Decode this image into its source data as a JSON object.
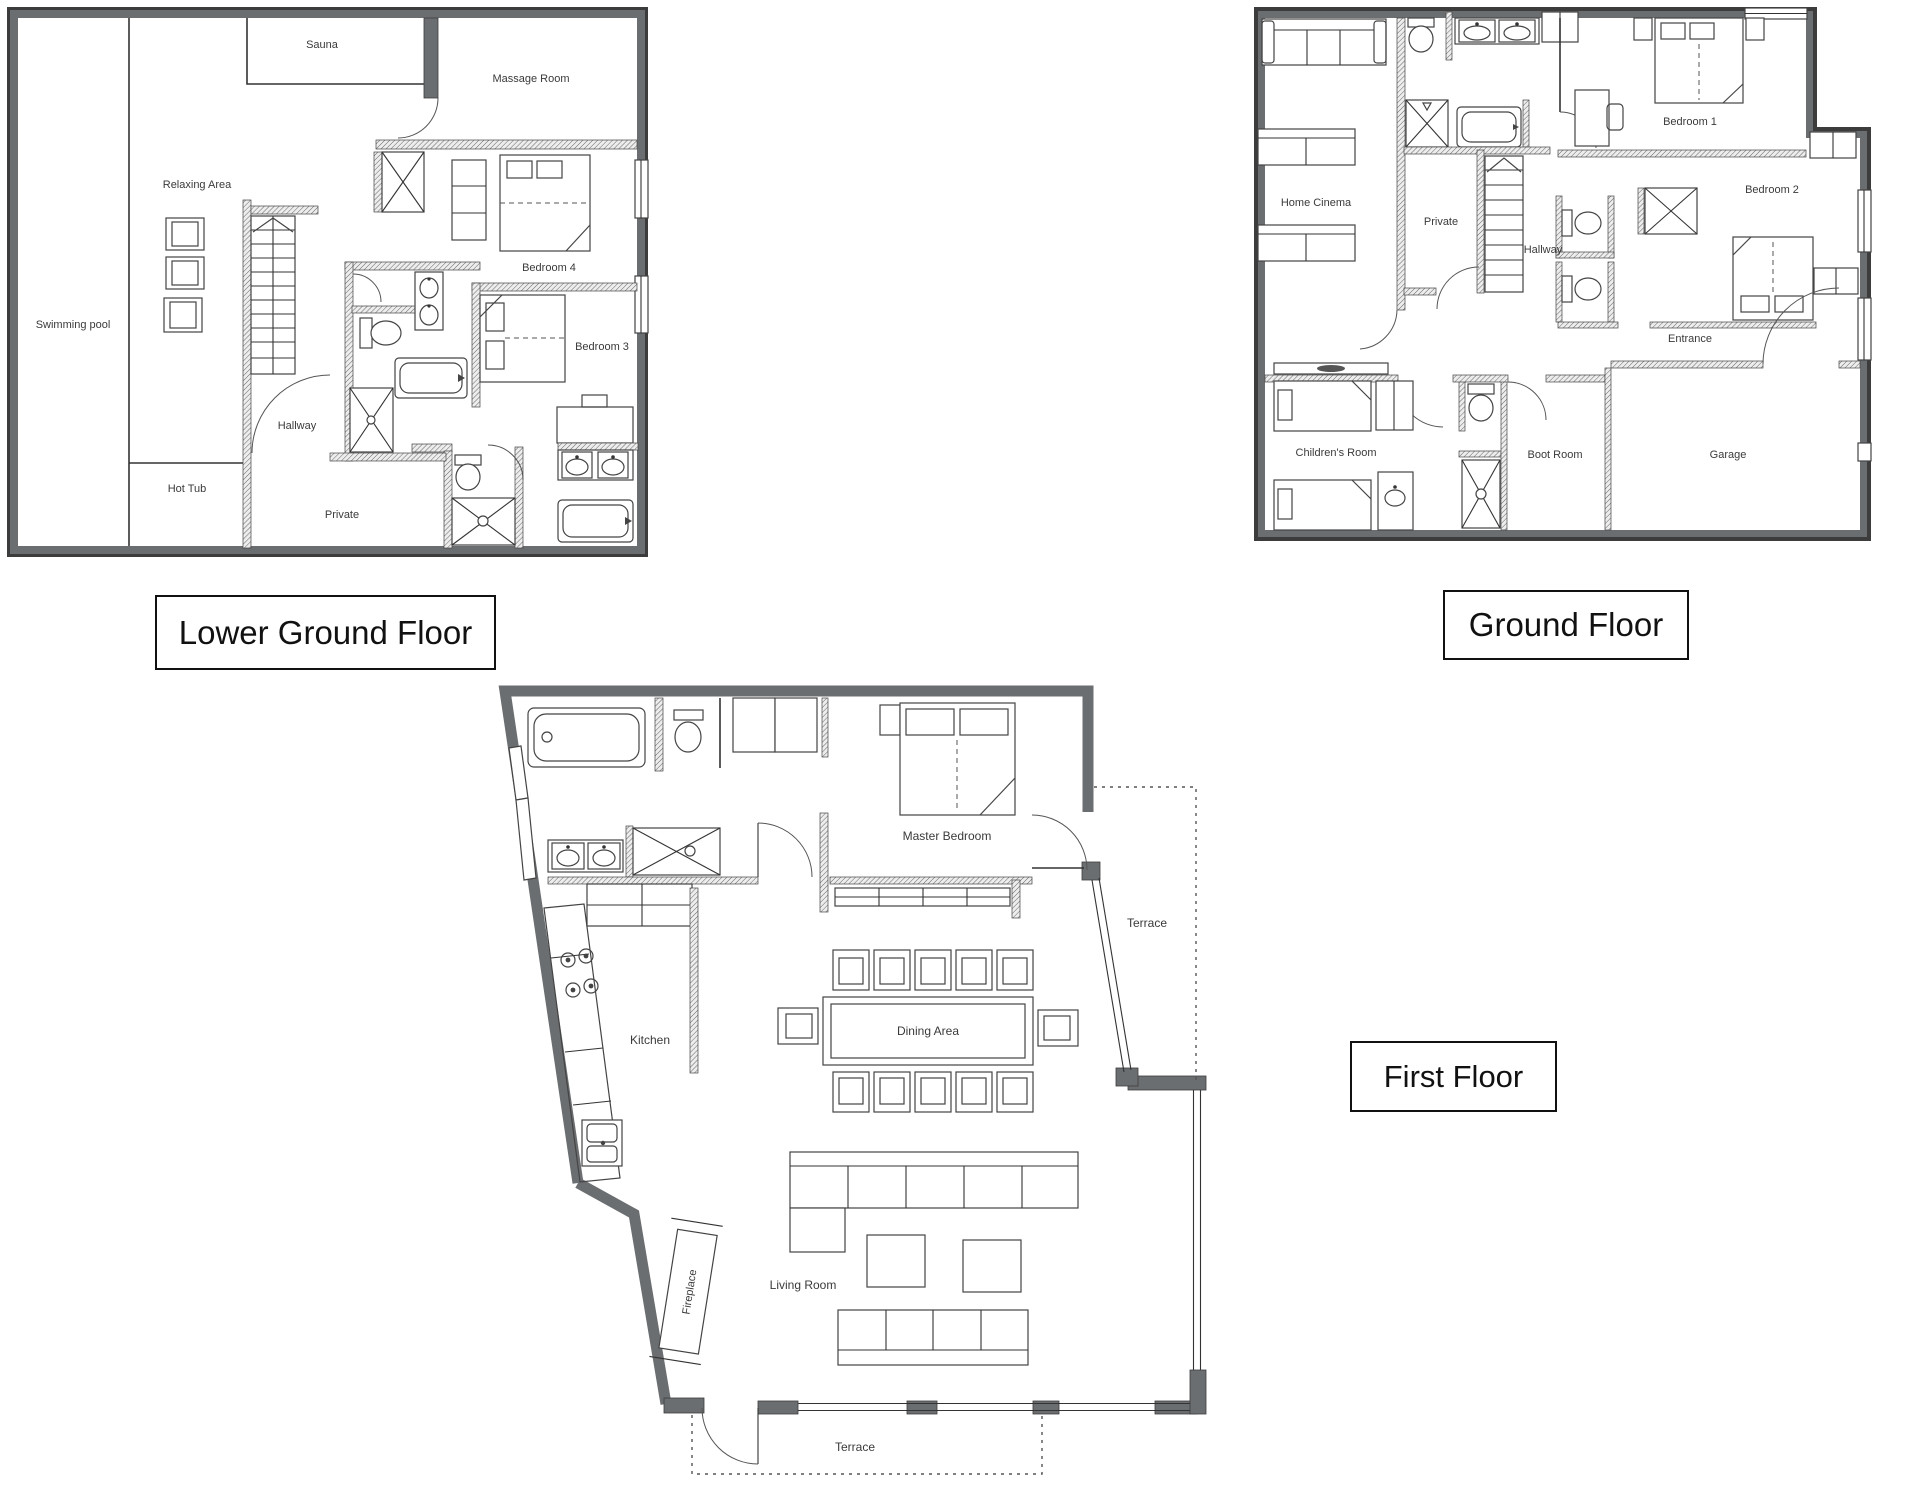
{
  "colors": {
    "wall_gray": "#6b6e70",
    "wall_edge": "#3c3c3c",
    "line": "#333333",
    "label_text": "#3a3a3a",
    "title_text": "#111111",
    "background": "#ffffff"
  },
  "floors": {
    "lower_ground": {
      "title": "Lower Ground Floor",
      "rooms": {
        "swimming_pool": "Swimming pool",
        "relaxing_area": "Relaxing Area",
        "sauna": "Sauna",
        "massage_room": "Massage Room",
        "bedroom4": "Bedroom 4",
        "hallway": "Hallway",
        "bedroom3": "Bedroom 3",
        "hot_tub": "Hot Tub",
        "private": "Private"
      }
    },
    "ground": {
      "title": "Ground Floor",
      "rooms": {
        "home_cinema": "Home Cinema",
        "private": "Private",
        "hallway": "Hallway",
        "bedroom1": "Bedroom 1",
        "bedroom2": "Bedroom 2",
        "entrance": "Entrance",
        "childrens_room": "Children's Room",
        "boot_room": "Boot Room",
        "garage": "Garage"
      }
    },
    "first": {
      "title": "First Floor",
      "rooms": {
        "master_bedroom": "Master Bedroom",
        "terrace_upper": "Terrace",
        "kitchen": "Kitchen",
        "dining_area": "Dining Area",
        "fireplace": "Fireplace",
        "living_room": "Living Room",
        "terrace_lower": "Terrace"
      }
    }
  },
  "icons": [
    "bed-icon",
    "toilet-icon",
    "shower-icon",
    "bathtub-icon",
    "sink-icon",
    "sofa-icon",
    "stairs-icon",
    "chair-icon",
    "dining-table-icon",
    "wardrobe-icon",
    "hob-icon",
    "media-console-icon",
    "fireplace-icon",
    "door-arc-icon",
    "window-icon"
  ]
}
